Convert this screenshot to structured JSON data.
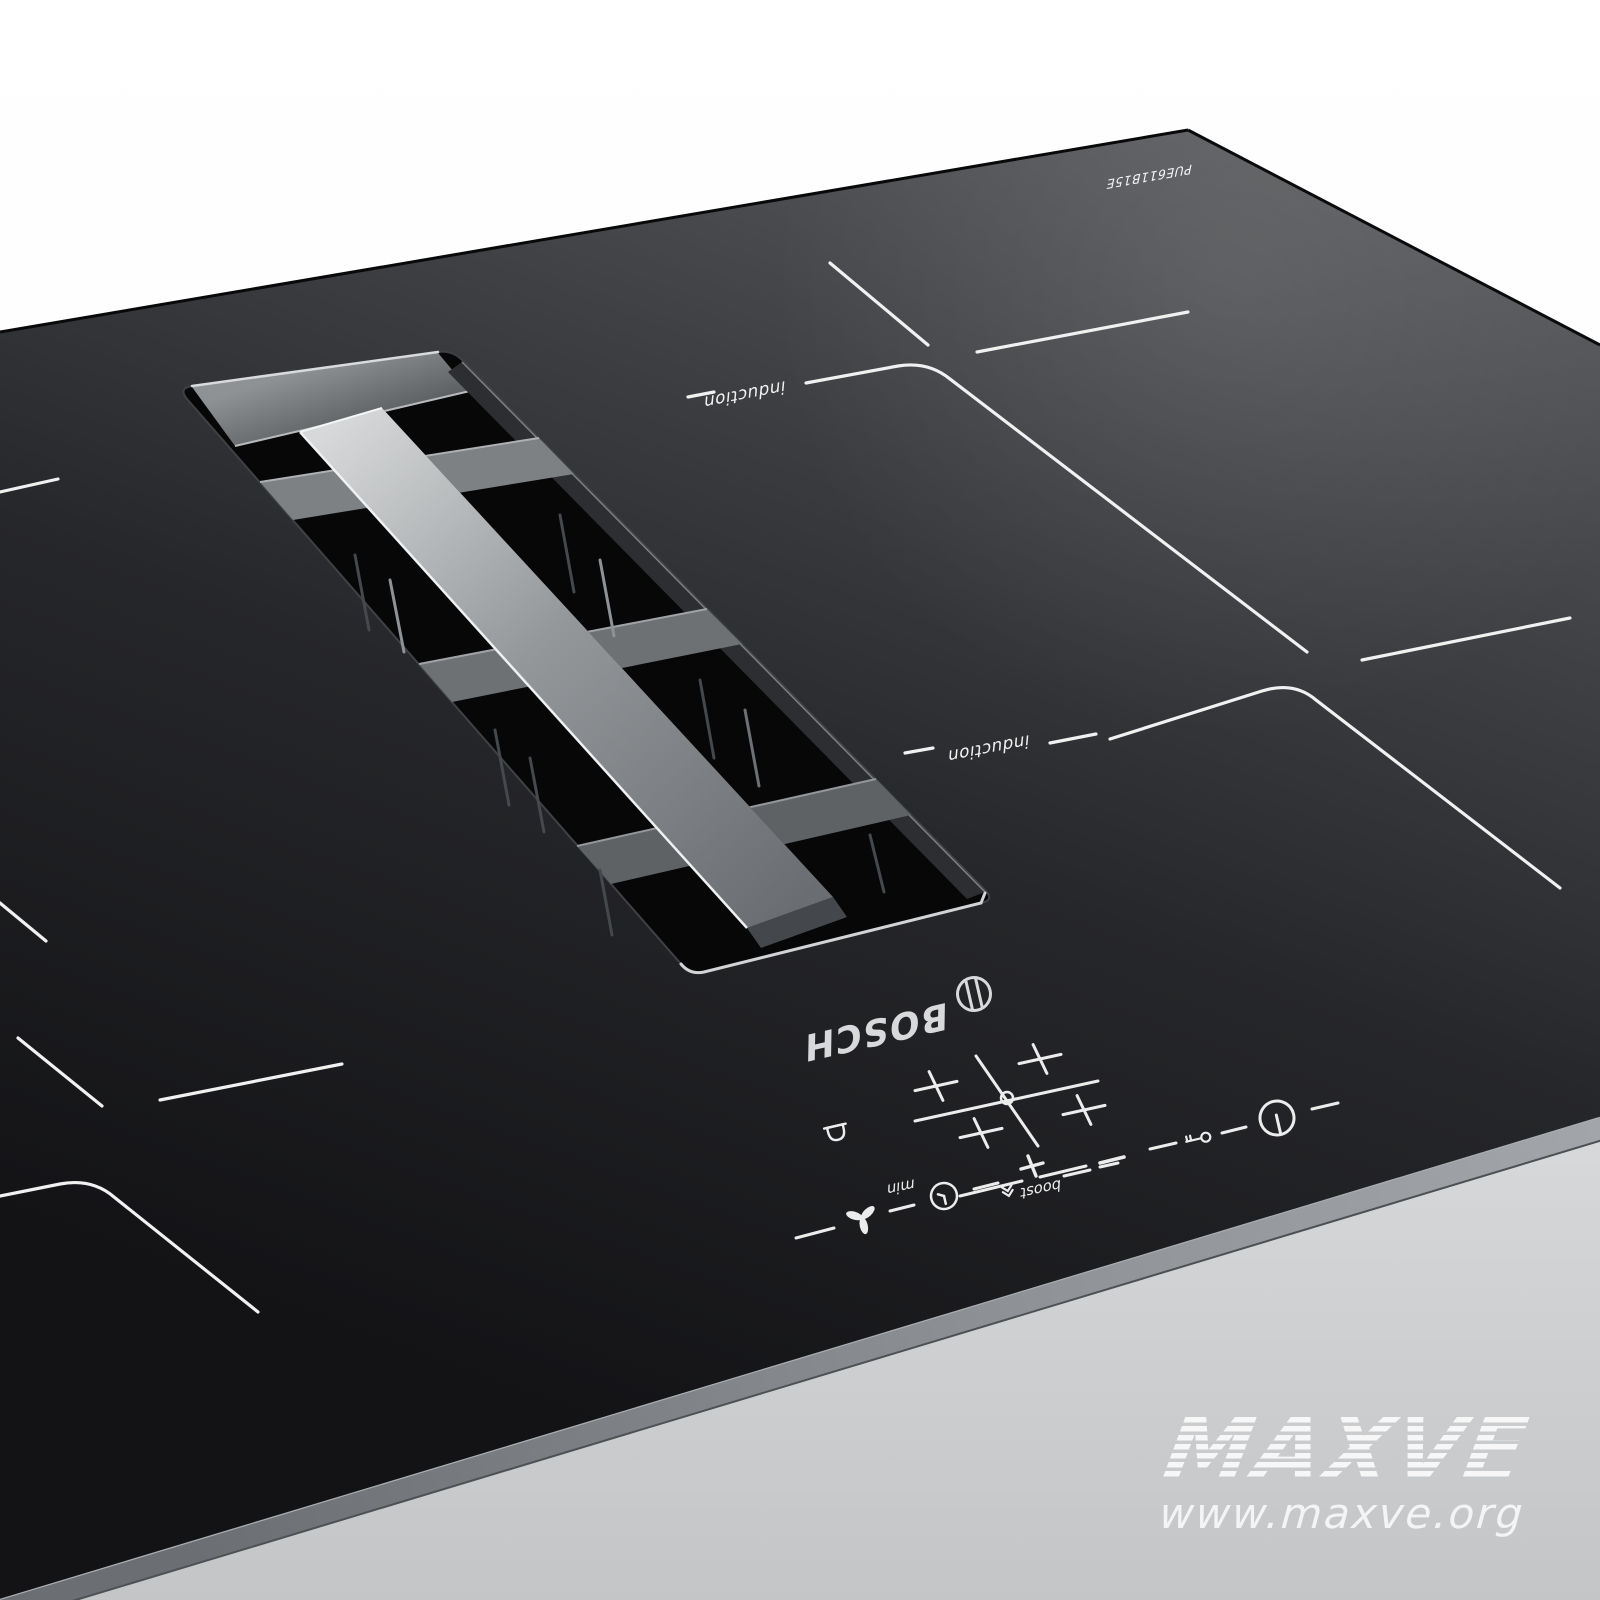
{
  "product": {
    "brand_logo": "BOSCH",
    "model_number": "PUE611B15E",
    "zone_labels": {
      "back": "induction",
      "front": "induction"
    },
    "controls": {
      "min_label": "min",
      "boost_label": "boost"
    },
    "icon_names": [
      "bosch-emblem-icon",
      "bell-icon",
      "zone-selector-icon",
      "minus-icon",
      "child-lock-key-icon",
      "power-icon",
      "fan-icon",
      "timer-clock-icon",
      "plus-icon",
      "boost-arrow-icon"
    ]
  },
  "watermark": {
    "title": "MAXVE",
    "url": "www.maxve.org"
  },
  "colors": {
    "glass_dark": "#131316",
    "glass_light": "#5a5c5f",
    "marking_white": "#f1f1f1",
    "trim_gray": "#8b8e92",
    "vent_metal_bar": "#c7c9cb",
    "background_top": "#ffffff",
    "background_bottom": "#c3c5c7"
  }
}
